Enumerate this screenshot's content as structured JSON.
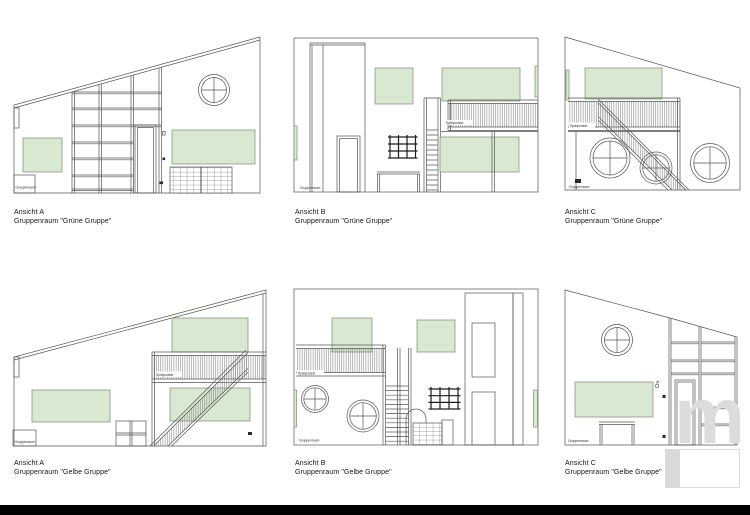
{
  "page": {
    "background": "#ffffff",
    "bottom_bar_color": "#000000"
  },
  "palette": {
    "line": "#555555",
    "green_fill": "#d9e8d1",
    "green_border": "#87997e",
    "black_grid": "#1c1c1c",
    "watermark_gray": "#dcdcdc",
    "caption_text": "#141414"
  },
  "labels": {
    "gruppenraum": "Gruppenraum",
    "spielpodest": "Spielpodest"
  },
  "watermark": {
    "letter": "m"
  },
  "drawings": [
    {
      "id": "gruene-a",
      "view": "Ansicht A",
      "room": "Gruppenraum \"Grüne Gruppe\""
    },
    {
      "id": "gruene-b",
      "view": "Ansicht B",
      "room": "Gruppenraum \"Grüne Gruppe\""
    },
    {
      "id": "gruene-c",
      "view": "Ansicht C",
      "room": "Gruppenraum \"Grüne Gruppe\""
    },
    {
      "id": "gelbe-a",
      "view": "Ansicht A",
      "room": "Gruppenraum \"Gelbe Gruppe\""
    },
    {
      "id": "gelbe-b",
      "view": "Ansicht B",
      "room": "Gruppenraum \"Gelbe Gruppe\""
    },
    {
      "id": "gelbe-c",
      "view": "Ansicht C",
      "room": "Gruppenraum \"Gelbe Gruppe\""
    }
  ]
}
